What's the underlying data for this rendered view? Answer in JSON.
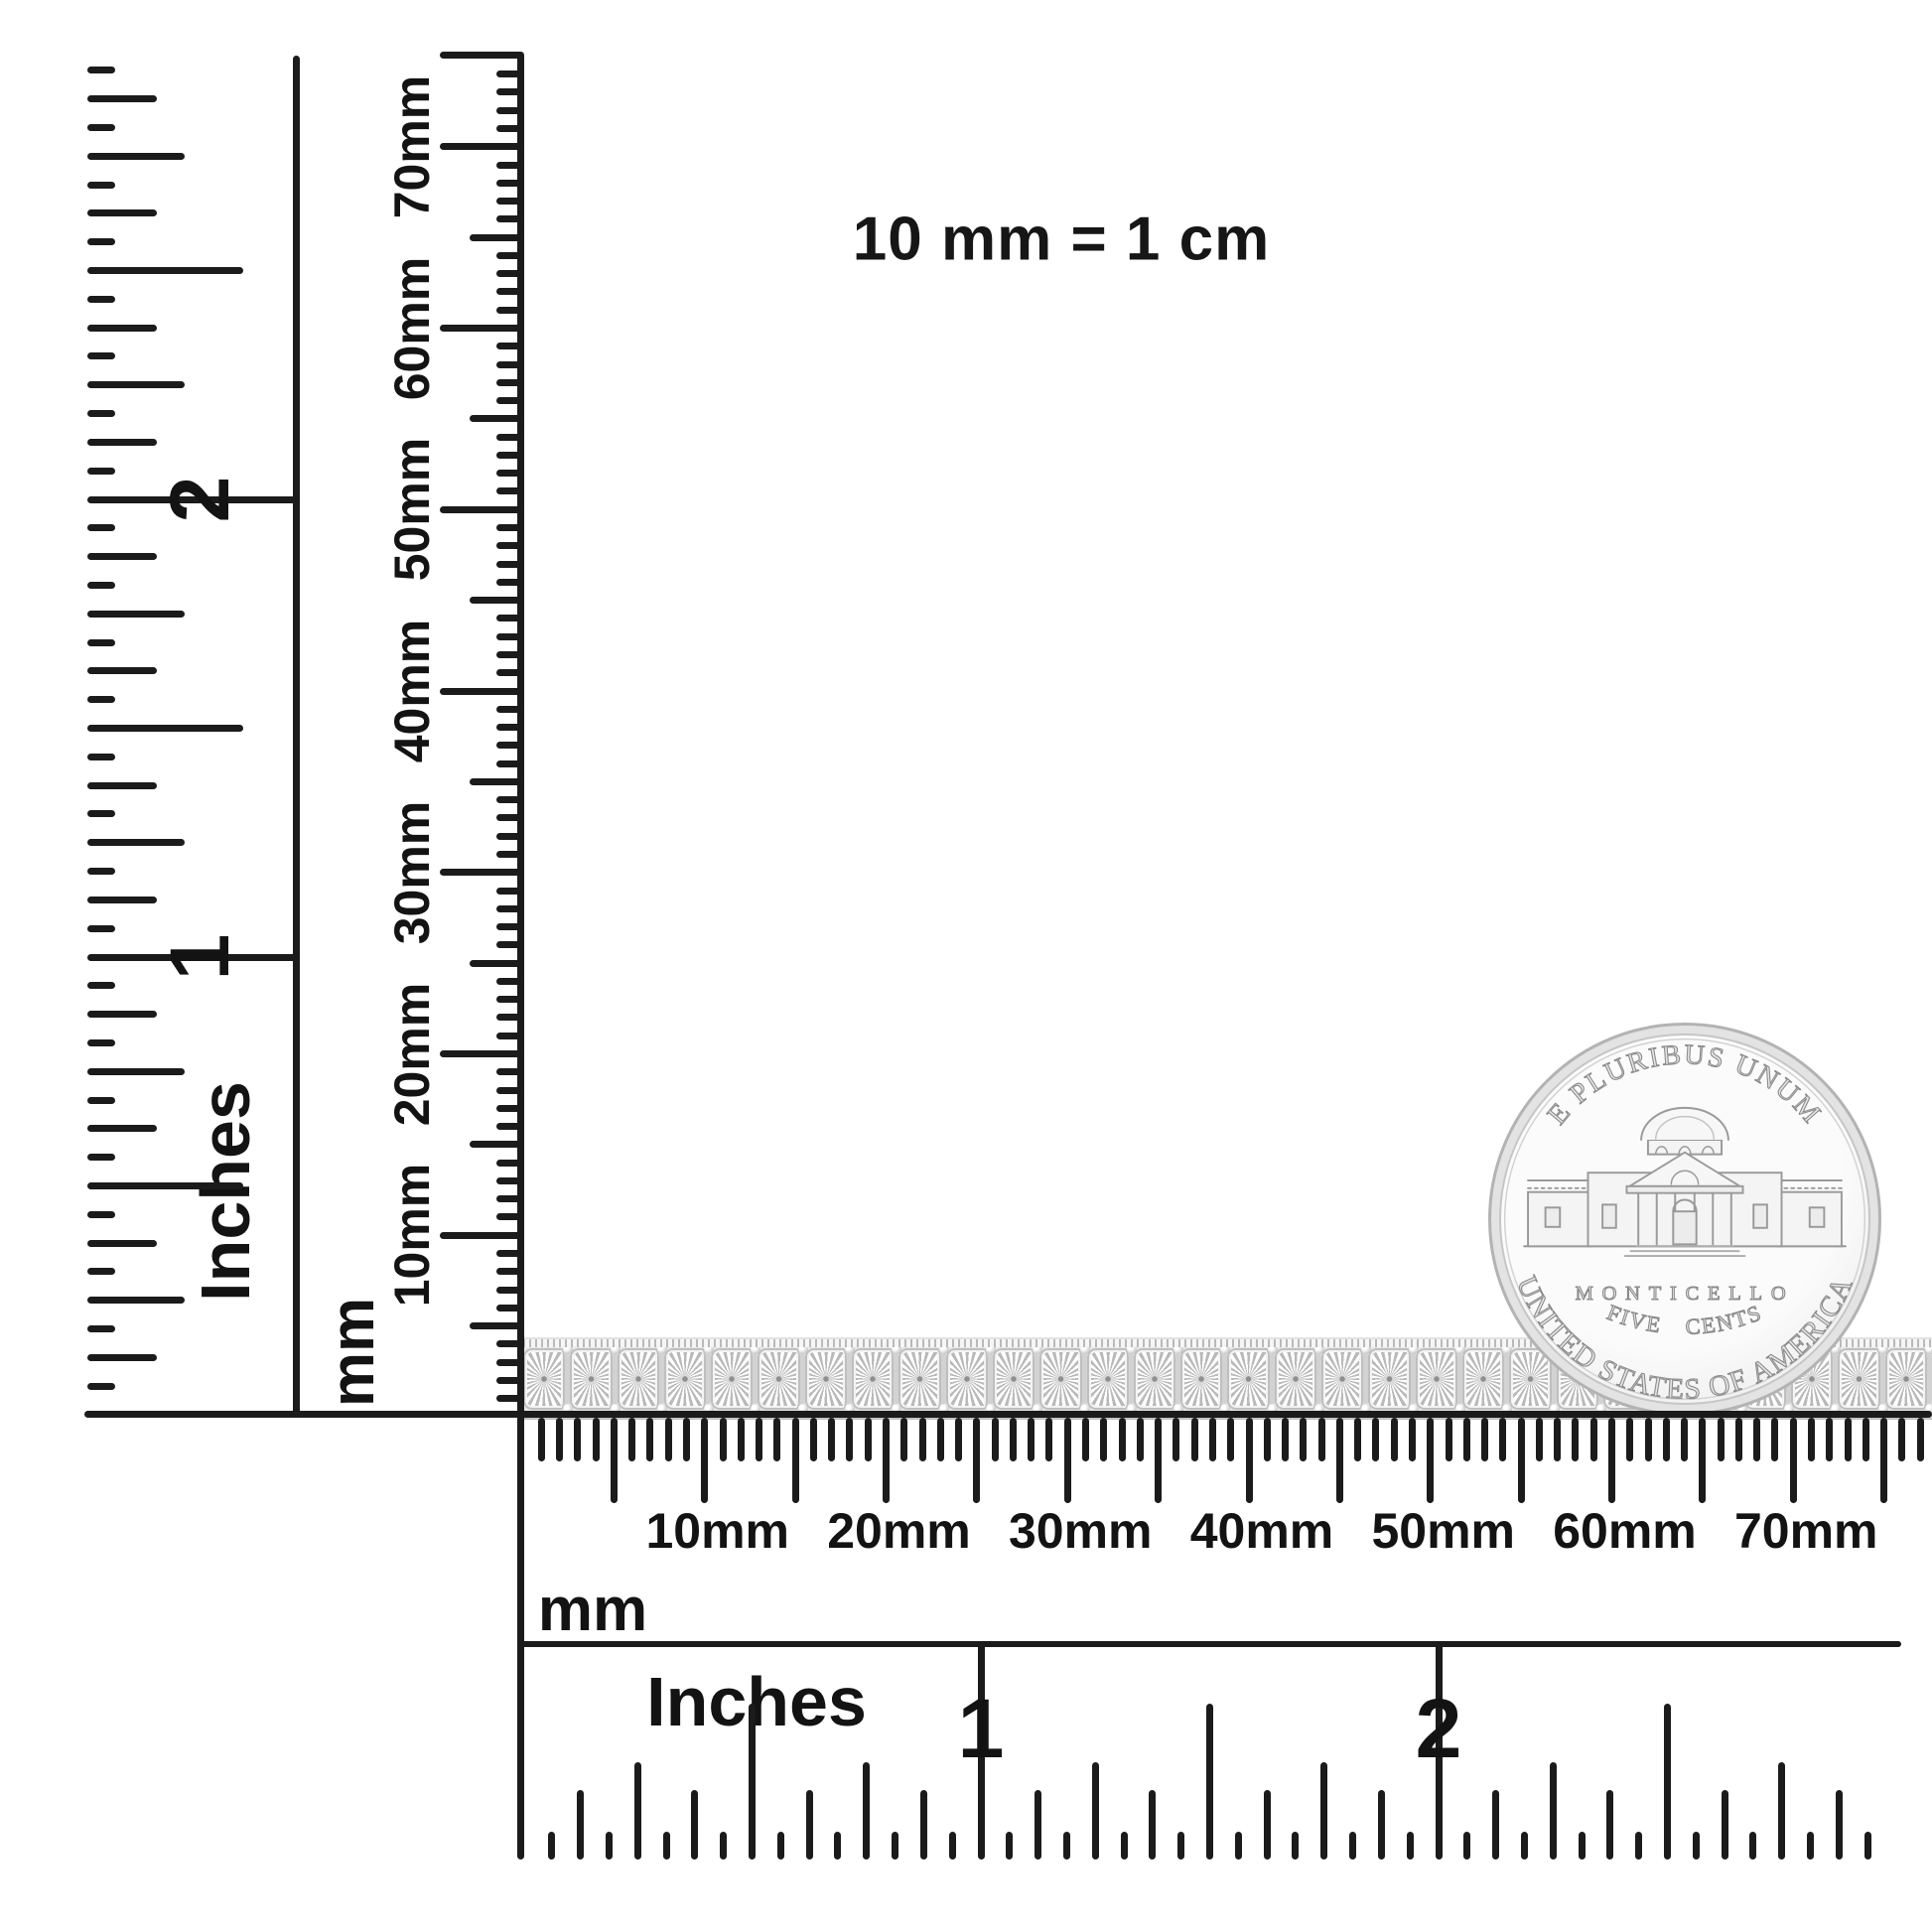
{
  "title": "10 mm = 1 cm",
  "rulers": {
    "vertical_inch": {
      "unit": "Inches",
      "numerals": [
        "1",
        "2"
      ]
    },
    "vertical_mm": {
      "unit": "mm",
      "labels": [
        "10mm",
        "20mm",
        "30mm",
        "40mm",
        "50mm",
        "60mm",
        "70mm"
      ]
    },
    "horizontal_mm": {
      "unit": "mm",
      "labels": [
        "10mm",
        "20mm",
        "30mm",
        "40mm",
        "50mm",
        "60mm",
        "70mm"
      ]
    },
    "horizontal_inch": {
      "unit": "Inches",
      "numerals": [
        "1",
        "2"
      ]
    }
  },
  "coin": {
    "legend_top": "E PLURIBUS UNUM",
    "building": "MONTICELLO",
    "denomination": "FIVE CENTS",
    "legend_bottom": "UNITED STATES OF AMERICA"
  },
  "bracelet": {
    "link_count": 30
  },
  "colors": {
    "background": "#ffffff",
    "ink": "#1b1b1b",
    "coin_silver": "#ececec",
    "bracelet_silver": "#e9e9e9",
    "metal_outline": "#9a9a9a"
  }
}
